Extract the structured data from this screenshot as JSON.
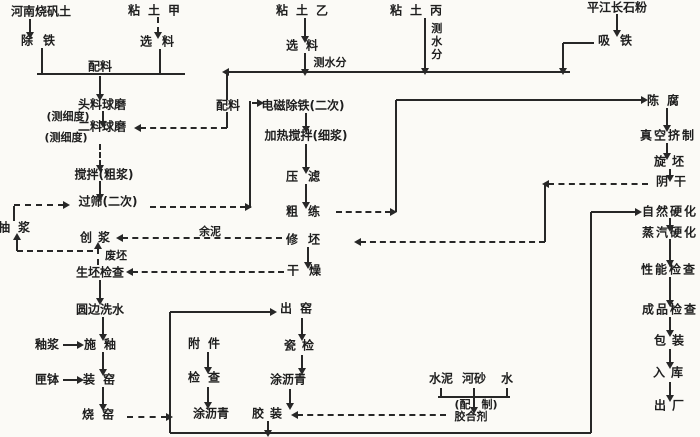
{
  "colors": {
    "ink": "#1e1e1e",
    "paper": "#fbfaf6"
  },
  "diagram": {
    "kind": "process-flowchart",
    "language": "zh",
    "nodes": [
      {
        "id": "henan-alum-clay",
        "label": "河南烧矾土"
      },
      {
        "id": "clay-a",
        "label": "粘土甲"
      },
      {
        "id": "clay-b",
        "label": "粘土乙"
      },
      {
        "id": "clay-c",
        "label": "粘土丙"
      },
      {
        "id": "pingjiang-feldspar",
        "label": "平江长石粉"
      },
      {
        "id": "remove-iron",
        "label": "除铁"
      },
      {
        "id": "select-a",
        "label": "选料"
      },
      {
        "id": "select-b",
        "label": "选料"
      },
      {
        "id": "measure-moisture-b",
        "label": "测水分"
      },
      {
        "id": "measure-moisture-c",
        "label": "测水分"
      },
      {
        "id": "magnet-iron",
        "label": "吸铁"
      },
      {
        "id": "batching-1",
        "label": "配料"
      },
      {
        "id": "batching-2",
        "label": "配料"
      },
      {
        "id": "first-ball-mill",
        "label": "头料球磨"
      },
      {
        "id": "fineness-1",
        "label": "(测细度)"
      },
      {
        "id": "second-ball-mill",
        "label": "二料球磨"
      },
      {
        "id": "fineness-2",
        "label": "(测细度)"
      },
      {
        "id": "stir-coarse-slip",
        "label": "搅拌(粗浆)"
      },
      {
        "id": "sieve-twice",
        "label": "过筛(二次)"
      },
      {
        "id": "pump-slip",
        "label": "抽浆"
      },
      {
        "id": "make-slip",
        "label": "创浆"
      },
      {
        "id": "waste-blank",
        "label": "废坯"
      },
      {
        "id": "green-blank-check",
        "label": "生坯检查"
      },
      {
        "id": "residual-mud",
        "label": "余泥"
      },
      {
        "id": "emag-deiron",
        "label": "电磁除铁(二次)"
      },
      {
        "id": "heat-stir-fine",
        "label": "加热搅拌(细浆)"
      },
      {
        "id": "filter-press",
        "label": "压滤"
      },
      {
        "id": "coarse-pug",
        "label": "粗练"
      },
      {
        "id": "trim-blank",
        "label": "修坯"
      },
      {
        "id": "drying",
        "label": "干燥"
      },
      {
        "id": "aging",
        "label": "陈腐"
      },
      {
        "id": "vacuum-extrude",
        "label": "真空挤制"
      },
      {
        "id": "jigger-blank",
        "label": "旋坯"
      },
      {
        "id": "shade-dry",
        "label": "阴干"
      },
      {
        "id": "natural-harden",
        "label": "自然硬化"
      },
      {
        "id": "steam-harden",
        "label": "蒸汽硬化"
      },
      {
        "id": "performance-check",
        "label": "性能检查"
      },
      {
        "id": "product-check",
        "label": "成品检查"
      },
      {
        "id": "packing",
        "label": "包装"
      },
      {
        "id": "warehouse",
        "label": "入库"
      },
      {
        "id": "ship-out",
        "label": "出厂"
      },
      {
        "id": "round-edge-wash",
        "label": "圆边洗水"
      },
      {
        "id": "glaze-slip",
        "label": "釉浆"
      },
      {
        "id": "apply-glaze",
        "label": "施釉"
      },
      {
        "id": "saggar",
        "label": "匣钵"
      },
      {
        "id": "load-kiln",
        "label": "装窑"
      },
      {
        "id": "fire-kiln",
        "label": "烧窑"
      },
      {
        "id": "accessories",
        "label": "附件"
      },
      {
        "id": "acc-check",
        "label": "检查"
      },
      {
        "id": "acc-asphalt",
        "label": "涂沥青"
      },
      {
        "id": "unload-kiln",
        "label": "出窑"
      },
      {
        "id": "porcelain-check",
        "label": "瓷检"
      },
      {
        "id": "coat-asphalt",
        "label": "涂沥青"
      },
      {
        "id": "cement-assemble",
        "label": "胶装"
      },
      {
        "id": "cement",
        "label": "水泥"
      },
      {
        "id": "river-sand",
        "label": "河砂"
      },
      {
        "id": "water",
        "label": "水"
      },
      {
        "id": "mix-prepare",
        "label": "(配　制)"
      },
      {
        "id": "adhesive",
        "label": "胶合剂"
      }
    ],
    "edges": [
      "henan-alum-clay>remove-iron",
      "clay-a>select-a",
      "remove-iron>batching-1",
      "select-a>batching-1",
      "batching-1>first-ball-mill",
      "first-ball-mill>second-ball-mill",
      "batching-2>second-ball-mill",
      "clay-b>select-b",
      "select-b>measure-moisture-b",
      "measure-moisture-b>batching-2",
      "clay-c>measure-moisture-c",
      "measure-moisture-c>batching-2",
      "pingjiang-feldspar>magnet-iron",
      "magnet-iron>batching-2",
      "second-ball-mill>stir-coarse-slip",
      "stir-coarse-slip>sieve-twice",
      "sieve-twice>emag-deiron",
      "emag-deiron>heat-stir-fine",
      "heat-stir-fine>filter-press",
      "filter-press>coarse-pug",
      "coarse-pug>aging",
      "aging>vacuum-extrude",
      "vacuum-extrude>jigger-blank",
      "jigger-blank>shade-dry",
      "shade-dry>trim-blank",
      "trim-blank>residual-mud",
      "residual-mud>make-slip",
      "trim-blank>drying",
      "drying>green-blank-check",
      "green-blank-check>waste-blank",
      "waste-blank>make-slip",
      "make-slip>pump-slip",
      "pump-slip>sieve-twice",
      "green-blank-check>round-edge-wash",
      "round-edge-wash>apply-glaze",
      "glaze-slip>apply-glaze",
      "apply-glaze>load-kiln",
      "saggar>load-kiln",
      "load-kiln>fire-kiln",
      "fire-kiln>unload-kiln",
      "unload-kiln>porcelain-check",
      "porcelain-check>coat-asphalt",
      "coat-asphalt>cement-assemble",
      "accessories>acc-check",
      "acc-check>acc-asphalt",
      "cement>adhesive",
      "river-sand>adhesive",
      "water>adhesive",
      "adhesive>cement-assemble",
      "cement-assemble>natural-harden",
      "natural-harden>steam-harden",
      "steam-harden>performance-check",
      "performance-check>product-check",
      "product-check>packing",
      "packing>warehouse",
      "warehouse>ship-out"
    ]
  }
}
